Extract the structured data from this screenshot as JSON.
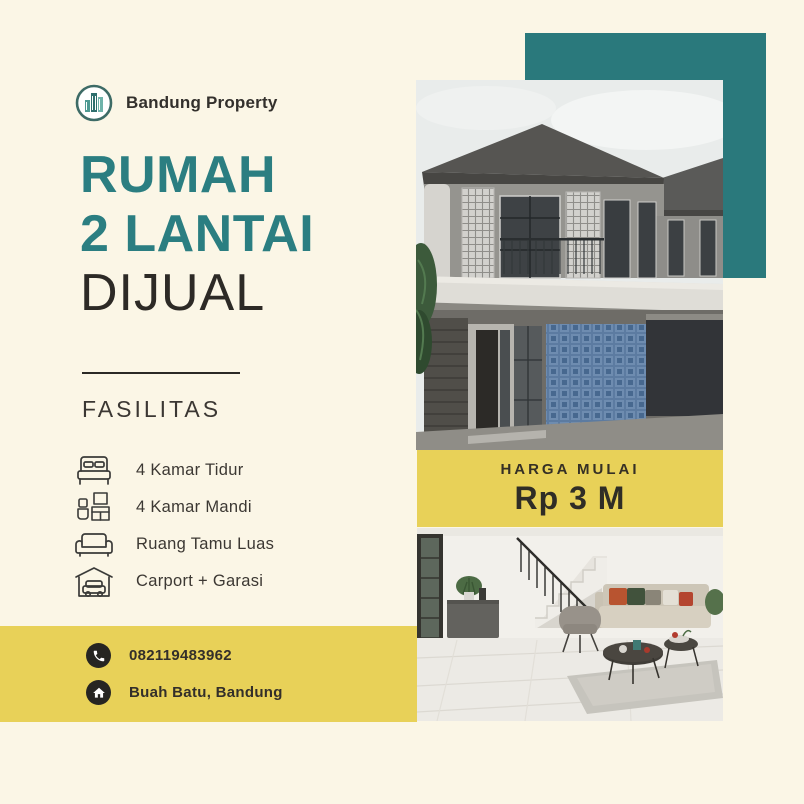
{
  "page": {
    "background_color": "#fbf6e6",
    "accent_teal": "#2a797c",
    "accent_yellow": "#e8d158",
    "text_dark": "#2d2a26"
  },
  "brand": {
    "logo_icon": "buildings-logo-icon",
    "name": "Bandung Property"
  },
  "headline": {
    "line1": "RUMAH",
    "line2": "2 LANTAI",
    "line3": "DIJUAL"
  },
  "facilities": {
    "heading": "FASILITAS",
    "items": [
      {
        "icon": "bed-icon",
        "label": "4 Kamar Tidur"
      },
      {
        "icon": "bathroom-icon",
        "label": "4 Kamar Mandi"
      },
      {
        "icon": "sofa-icon",
        "label": "Ruang Tamu Luas"
      },
      {
        "icon": "garage-car-icon",
        "label": "Carport + Garasi"
      }
    ]
  },
  "price": {
    "label": "HARGA MULAI",
    "value": "Rp 3 M"
  },
  "contact": {
    "phone": {
      "icon": "phone-icon",
      "value": "082119483962"
    },
    "location": {
      "icon": "home-icon",
      "value": "Buah Batu, Bandung"
    }
  },
  "photos": {
    "exterior": "two-story modern house exterior",
    "interior": "living room with staircase"
  }
}
